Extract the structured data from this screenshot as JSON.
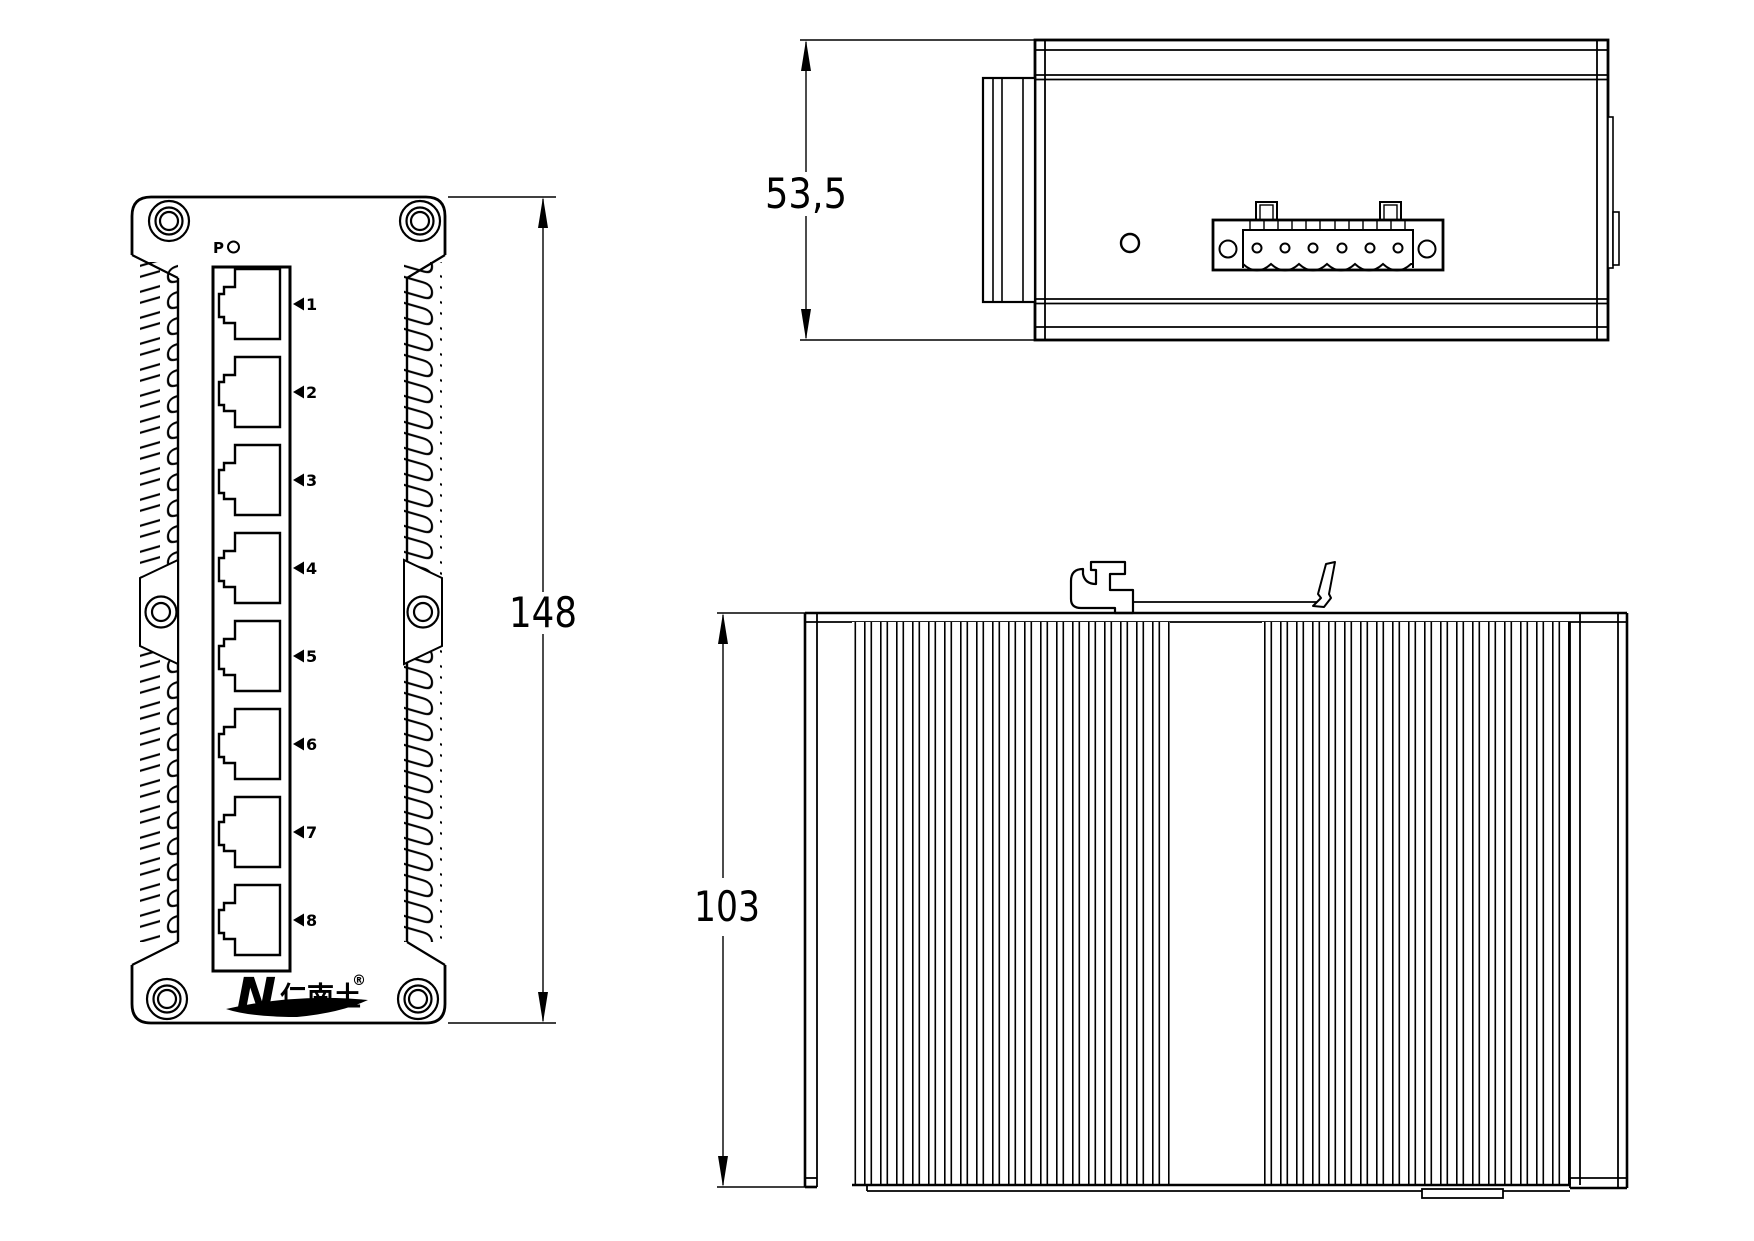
{
  "front": {
    "indicator_label": "P",
    "port_numbers": [
      "1",
      "2",
      "3",
      "4",
      "5",
      "6",
      "7",
      "8"
    ],
    "logo_n": "N",
    "logo_cjk": "仁南土",
    "logo_reg": "®",
    "dim_label": "148"
  },
  "top": {
    "dim_label": "53,5"
  },
  "side": {
    "dim_label": "103"
  },
  "colors": {
    "line": "#000000",
    "background": "#ffffff"
  }
}
